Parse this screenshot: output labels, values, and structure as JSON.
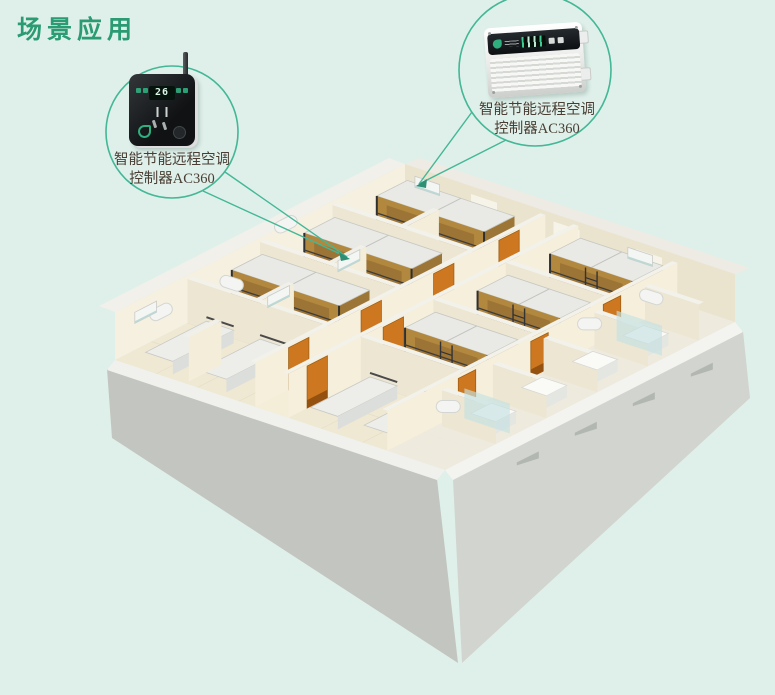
{
  "page": {
    "title": "场景应用",
    "background_color": "#dff0ea",
    "title_color": "#2a9b72"
  },
  "callouts": {
    "left": {
      "label_line1": "智能节能远程空调",
      "label_line2": "控制器AC360",
      "device_icon": "wall-thermostat-ac360",
      "display_value": "26"
    },
    "right": {
      "label_line1": "智能节能远程空调",
      "label_line2": "控制器AC360",
      "device_icon": "din-controller-box-ac360"
    }
  },
  "colors": {
    "accent_circle": "#43b796",
    "label_text": "#4a3e34",
    "door_orange": "#cd7820",
    "bin_blue": "#2f86c8",
    "bed_wood": "#b2883f",
    "wall_cream": "#f5efdc",
    "floor_cream": "#efe8d2",
    "facade_gray_left": "#c3c5c0",
    "facade_gray_right": "#d2d4cf",
    "device_green": "#2fae7e"
  }
}
